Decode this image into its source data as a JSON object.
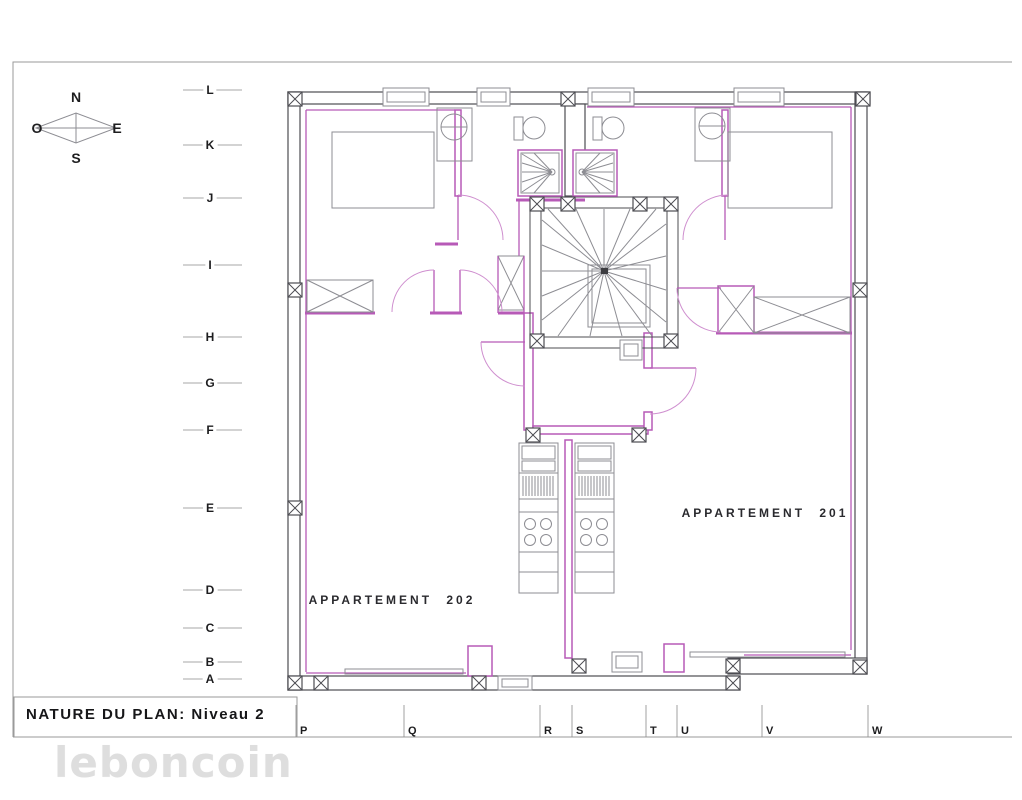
{
  "sheet": {
    "title": "NATURE DU PLAN: Niveau 2",
    "watermark": "leboncoin"
  },
  "compass": {
    "north": "N",
    "east": "E",
    "south": "S",
    "west": "O"
  },
  "apartments": {
    "left": {
      "label": "APPARTEMENT 202"
    },
    "right": {
      "label": "APPARTEMENT 201"
    }
  },
  "grid": {
    "rows": [
      "L",
      "K",
      "J",
      "I",
      "H",
      "G",
      "F",
      "E",
      "D",
      "C",
      "B",
      "A"
    ],
    "cols": [
      "P",
      "Q",
      "R",
      "S",
      "T",
      "U",
      "V",
      "W"
    ]
  },
  "colors": {
    "wall": "#4c4c52",
    "partition": "#b75ab7",
    "fixture": "#8d8d93",
    "watermark": "#dedede"
  }
}
